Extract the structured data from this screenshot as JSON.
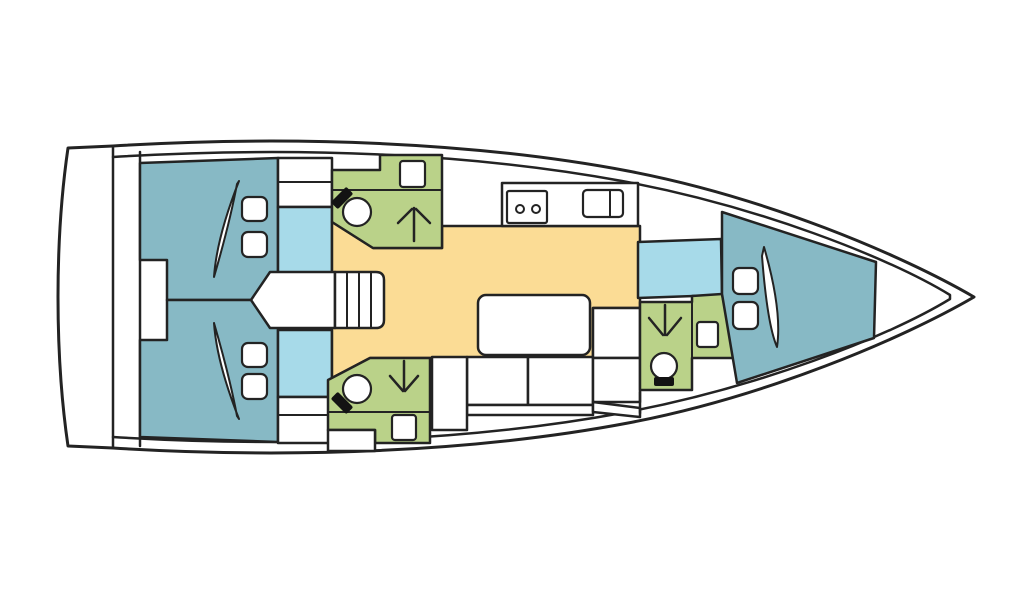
{
  "canvas": {
    "w": 1024,
    "h": 600,
    "bg": "#ffffff"
  },
  "palette": {
    "outline": "#232323",
    "white": "#ffffff",
    "cabin": "#87b9c5",
    "corridor": "#a7dae9",
    "saloon": "#fbdc95",
    "head": "#bad289",
    "black": "#131313"
  },
  "shapes": [
    {
      "name": "hull-outline",
      "kind": "path",
      "d": "M 68 148 L 113 146 C 290 135 475 142 628 171 C 765 197 902 255 974 297 C 902 339 765 397 628 423 C 475 452 290 459 113 448 L 68 446 C 61 398 58 348 58 297 C 58 246 61 196 68 148 Z",
      "fill": "white",
      "sw": 3
    },
    {
      "name": "transom-wall-line",
      "kind": "line",
      "x1": 113,
      "y1": 146,
      "x2": 113,
      "y2": 448,
      "sw": 2.5
    },
    {
      "name": "aft-bulkhead-line",
      "kind": "line",
      "x1": 140,
      "y1": 152,
      "x2": 140,
      "y2": 446,
      "sw": 2.5
    },
    {
      "name": "deck-inner-line",
      "kind": "path",
      "d": "M 113 157 C 292 146 470 153 622 181 C 757 206 888 257 950 295 L 950 299 C 888 337 757 388 622 413 C 470 441 292 448 113 437",
      "sw": 2.5
    },
    {
      "name": "aft-cabin-port",
      "kind": "path",
      "d": "M 140 163 L 278 158 L 278 300 L 167 300 L 167 260 L 140 260 Z",
      "fill": "cabin",
      "sw": 2.5
    },
    {
      "name": "aft-cabin-starboard",
      "kind": "path",
      "d": "M 167 300 L 278 300 L 278 442 L 140 437 L 140 340 L 167 340 Z",
      "fill": "cabin",
      "sw": 2.5
    },
    {
      "name": "berth-pillow",
      "kind": "rect",
      "x": 242,
      "y": 197,
      "w": 25,
      "h": 24,
      "rx": 6,
      "fill": "white",
      "sw": 2.2
    },
    {
      "name": "berth-pillow",
      "kind": "rect",
      "x": 242,
      "y": 232,
      "w": 25,
      "h": 25,
      "rx": 6,
      "fill": "white",
      "sw": 2.2
    },
    {
      "name": "mattress-split",
      "kind": "path",
      "d": "M 239 181 C 226 214 216 248 214 277 C 223 246 232 211 237 184 Z",
      "fill": "white",
      "sw": 2
    },
    {
      "name": "berth-pillow",
      "kind": "rect",
      "x": 242,
      "y": 343,
      "w": 25,
      "h": 24,
      "rx": 6,
      "fill": "white",
      "sw": 2.2
    },
    {
      "name": "berth-pillow",
      "kind": "rect",
      "x": 242,
      "y": 374,
      "w": 25,
      "h": 25,
      "rx": 6,
      "fill": "white",
      "sw": 2.2
    },
    {
      "name": "mattress-split",
      "kind": "path",
      "d": "M 239 419 C 226 386 216 352 214 323 C 223 354 232 389 237 416 Z",
      "fill": "white",
      "sw": 2
    },
    {
      "name": "wardrobe-port",
      "kind": "rect",
      "x": 278,
      "y": 158,
      "w": 54,
      "h": 49,
      "fill": "white",
      "sw": 2.5
    },
    {
      "name": "wardrobe-shelf-line",
      "kind": "line",
      "x1": 278,
      "y1": 182,
      "x2": 332,
      "y2": 182,
      "sw": 2
    },
    {
      "name": "corridor-port",
      "kind": "rect",
      "x": 278,
      "y": 207,
      "w": 54,
      "h": 66,
      "fill": "corridor",
      "sw": 2.5
    },
    {
      "name": "corridor-starboard",
      "kind": "rect",
      "x": 278,
      "y": 330,
      "w": 54,
      "h": 67,
      "fill": "corridor",
      "sw": 2.5
    },
    {
      "name": "wardrobe-starboard",
      "kind": "rect",
      "x": 278,
      "y": 397,
      "w": 54,
      "h": 46,
      "fill": "white",
      "sw": 2.5
    },
    {
      "name": "wardrobe-shelf-line",
      "kind": "line",
      "x1": 278,
      "y1": 415,
      "x2": 332,
      "y2": 415,
      "sw": 2
    },
    {
      "name": "saloon-floor",
      "kind": "path",
      "d": "M 332 222 L 373 248 L 442 248 L 442 226 L 640 226 L 640 308 L 593 308 L 593 358 L 370 358 L 332 378 Z",
      "fill": "saloon",
      "sw": 2.5
    },
    {
      "name": "engine-compartment",
      "kind": "path",
      "d": "M 251 300 L 270 272 L 335 272 L 335 328 L 270 328 Z",
      "fill": "white",
      "sw": 2.5
    },
    {
      "name": "companionway-steps",
      "kind": "path",
      "d": "M 335 272 L 376 272 Q 384 272 384 280 L 384 320 Q 384 328 376 328 L 335 328 Z",
      "fill": "white",
      "sw": 2.5
    },
    {
      "name": "step-tread-line",
      "kind": "line",
      "x1": 347,
      "y1": 272,
      "x2": 347,
      "y2": 328,
      "sw": 2
    },
    {
      "name": "step-tread-line",
      "kind": "line",
      "x1": 359,
      "y1": 272,
      "x2": 359,
      "y2": 328,
      "sw": 2
    },
    {
      "name": "step-tread-line",
      "kind": "line",
      "x1": 371,
      "y1": 272,
      "x2": 371,
      "y2": 328,
      "sw": 2
    },
    {
      "name": "head-port-room",
      "kind": "path",
      "d": "M 332 170 L 380 170 L 380 155 L 442 155 L 442 248 L 373 248 L 332 222 Z",
      "fill": "head",
      "sw": 2.5
    },
    {
      "name": "vanity-edge-line",
      "kind": "line",
      "x1": 332,
      "y1": 190,
      "x2": 442,
      "y2": 190,
      "sw": 2
    },
    {
      "name": "washbasin",
      "kind": "rect",
      "x": 400,
      "y": 161,
      "w": 25,
      "h": 26,
      "rx": 3,
      "fill": "white",
      "sw": 2.2
    },
    {
      "name": "toilet-bowl",
      "kind": "circle",
      "cx": 357,
      "cy": 212,
      "r": 14,
      "fill": "white",
      "sw": 2.2
    },
    {
      "name": "toilet-seat",
      "kind": "rect",
      "x": -11,
      "y": -5,
      "w": 22,
      "h": 10,
      "rx": 2,
      "fill": "black",
      "sw": 0,
      "transform": "translate(342 198) rotate(-45)"
    },
    {
      "name": "shower-arrow",
      "kind": "path",
      "d": "M 414 208 L 414 241 M 398 223 L 412 209 M 430 223 L 416 209",
      "sw": 2.5
    },
    {
      "name": "head-starboard-room",
      "kind": "path",
      "d": "M 328 380 L 370 358 L 430 358 L 430 443 L 375 443 L 375 430 L 328 430 Z",
      "fill": "head",
      "sw": 2.5
    },
    {
      "name": "vanity-edge-line",
      "kind": "line",
      "x1": 328,
      "y1": 412,
      "x2": 430,
      "y2": 412,
      "sw": 2
    },
    {
      "name": "washbasin",
      "kind": "rect",
      "x": 392,
      "y": 415,
      "w": 24,
      "h": 25,
      "rx": 3,
      "fill": "white",
      "sw": 2.2
    },
    {
      "name": "toilet-bowl",
      "kind": "circle",
      "cx": 357,
      "cy": 389,
      "r": 14,
      "fill": "white",
      "sw": 2.2
    },
    {
      "name": "toilet-seat",
      "kind": "rect",
      "x": -11,
      "y": -5,
      "w": 22,
      "h": 10,
      "rx": 2,
      "fill": "black",
      "sw": 0,
      "transform": "translate(342 403) rotate(45)"
    },
    {
      "name": "shower-arrow",
      "kind": "path",
      "d": "M 404 361 L 404 390 M 390 376 L 403 391 M 418 376 L 405 391",
      "sw": 2.5
    },
    {
      "name": "storage-locker",
      "kind": "rect",
      "x": 328,
      "y": 430,
      "w": 47,
      "h": 21,
      "fill": "white",
      "sw": 2.5
    },
    {
      "name": "galley-counter",
      "kind": "rect",
      "x": 502,
      "y": 183,
      "w": 136,
      "h": 43,
      "fill": "white",
      "sw": 2.5
    },
    {
      "name": "stove",
      "kind": "rect",
      "x": 507,
      "y": 191,
      "w": 40,
      "h": 32,
      "rx": 2,
      "fill": "white",
      "sw": 2.2
    },
    {
      "name": "stove-burner",
      "kind": "circle",
      "cx": 520,
      "cy": 209,
      "r": 4,
      "fill": "white",
      "sw": 2
    },
    {
      "name": "stove-burner",
      "kind": "circle",
      "cx": 536,
      "cy": 209,
      "r": 4,
      "fill": "white",
      "sw": 2
    },
    {
      "name": "galley-sink",
      "kind": "rect",
      "x": 583,
      "y": 190,
      "w": 40,
      "h": 27,
      "rx": 4,
      "fill": "white",
      "sw": 2.2
    },
    {
      "name": "sink-divider-line",
      "kind": "line",
      "x1": 610,
      "y1": 190,
      "x2": 610,
      "y2": 217,
      "sw": 2
    },
    {
      "name": "saloon-table",
      "kind": "rect",
      "x": 478,
      "y": 295,
      "w": 112,
      "h": 60,
      "rx": 8,
      "fill": "white",
      "sw": 2.5
    },
    {
      "name": "settee-seat",
      "kind": "rect",
      "x": 467,
      "y": 357,
      "w": 61,
      "h": 48,
      "fill": "white",
      "sw": 2.5
    },
    {
      "name": "settee-seat",
      "kind": "rect",
      "x": 528,
      "y": 357,
      "w": 65,
      "h": 48,
      "fill": "white",
      "sw": 2.5
    },
    {
      "name": "settee-backrest",
      "kind": "rect",
      "x": 467,
      "y": 405,
      "w": 126,
      "h": 10,
      "fill": "white",
      "sw": 2.5
    },
    {
      "name": "nav-seat",
      "kind": "rect",
      "x": 593,
      "y": 308,
      "w": 47,
      "h": 50,
      "fill": "white",
      "sw": 2.5
    },
    {
      "name": "nav-seat",
      "kind": "rect",
      "x": 593,
      "y": 358,
      "w": 47,
      "h": 44,
      "fill": "white",
      "sw": 2.5
    },
    {
      "name": "nav-backrest",
      "kind": "path",
      "d": "M 593 402 L 640 408 L 640 417 L 593 412 Z",
      "fill": "white",
      "sw": 2.5
    },
    {
      "name": "storage-locker",
      "kind": "rect",
      "x": 432,
      "y": 357,
      "w": 35,
      "h": 73,
      "fill": "white",
      "sw": 2.5
    },
    {
      "name": "corridor-forward",
      "kind": "path",
      "d": "M 638 242 L 721 239 L 722 295 L 638 298 Z",
      "fill": "corridor",
      "sw": 2.5
    },
    {
      "name": "head-forward-room",
      "kind": "path",
      "d": "M 640 302 L 692 302 L 692 296 L 722 294 L 735 358 L 692 358 L 692 390 L 640 390 Z",
      "fill": "head",
      "sw": 2.5
    },
    {
      "name": "head-partition-line",
      "kind": "line",
      "x1": 692,
      "y1": 296,
      "x2": 692,
      "y2": 390,
      "sw": 2
    },
    {
      "name": "washbasin",
      "kind": "rect",
      "x": 697,
      "y": 322,
      "w": 21,
      "h": 25,
      "rx": 3,
      "fill": "white",
      "sw": 2.2
    },
    {
      "name": "toilet-bowl",
      "kind": "circle",
      "cx": 664,
      "cy": 366,
      "r": 13,
      "fill": "white",
      "sw": 2.2
    },
    {
      "name": "toilet-seat",
      "kind": "rect",
      "x": -10,
      "y": -4,
      "w": 20,
      "h": 9,
      "rx": 2,
      "fill": "black",
      "sw": 0,
      "transform": "translate(664 381)"
    },
    {
      "name": "shower-arrow",
      "kind": "path",
      "d": "M 665 305 L 665 335 M 649 318 L 663 335 M 681 318 L 667 335",
      "sw": 2.5
    },
    {
      "name": "locker-wall-line",
      "kind": "line",
      "x1": 640,
      "y1": 392,
      "x2": 640,
      "y2": 413,
      "sw": 2.5
    },
    {
      "name": "forward-cabin",
      "kind": "path",
      "d": "M 722 212 L 876 262 L 874 338 L 737 383 L 722 294 Z",
      "fill": "cabin",
      "sw": 2.5
    },
    {
      "name": "berth-pillow",
      "kind": "rect",
      "x": 733,
      "y": 268,
      "w": 25,
      "h": 26,
      "rx": 6,
      "fill": "white",
      "sw": 2.2
    },
    {
      "name": "berth-pillow",
      "kind": "rect",
      "x": 733,
      "y": 302,
      "w": 25,
      "h": 27,
      "rx": 6,
      "fill": "white",
      "sw": 2.2
    },
    {
      "name": "mattress-split",
      "kind": "path",
      "d": "M 764 247 C 775 285 781 320 777 347 C 770 331 765 295 762 256 Z",
      "fill": "white",
      "sw": 2
    }
  ]
}
